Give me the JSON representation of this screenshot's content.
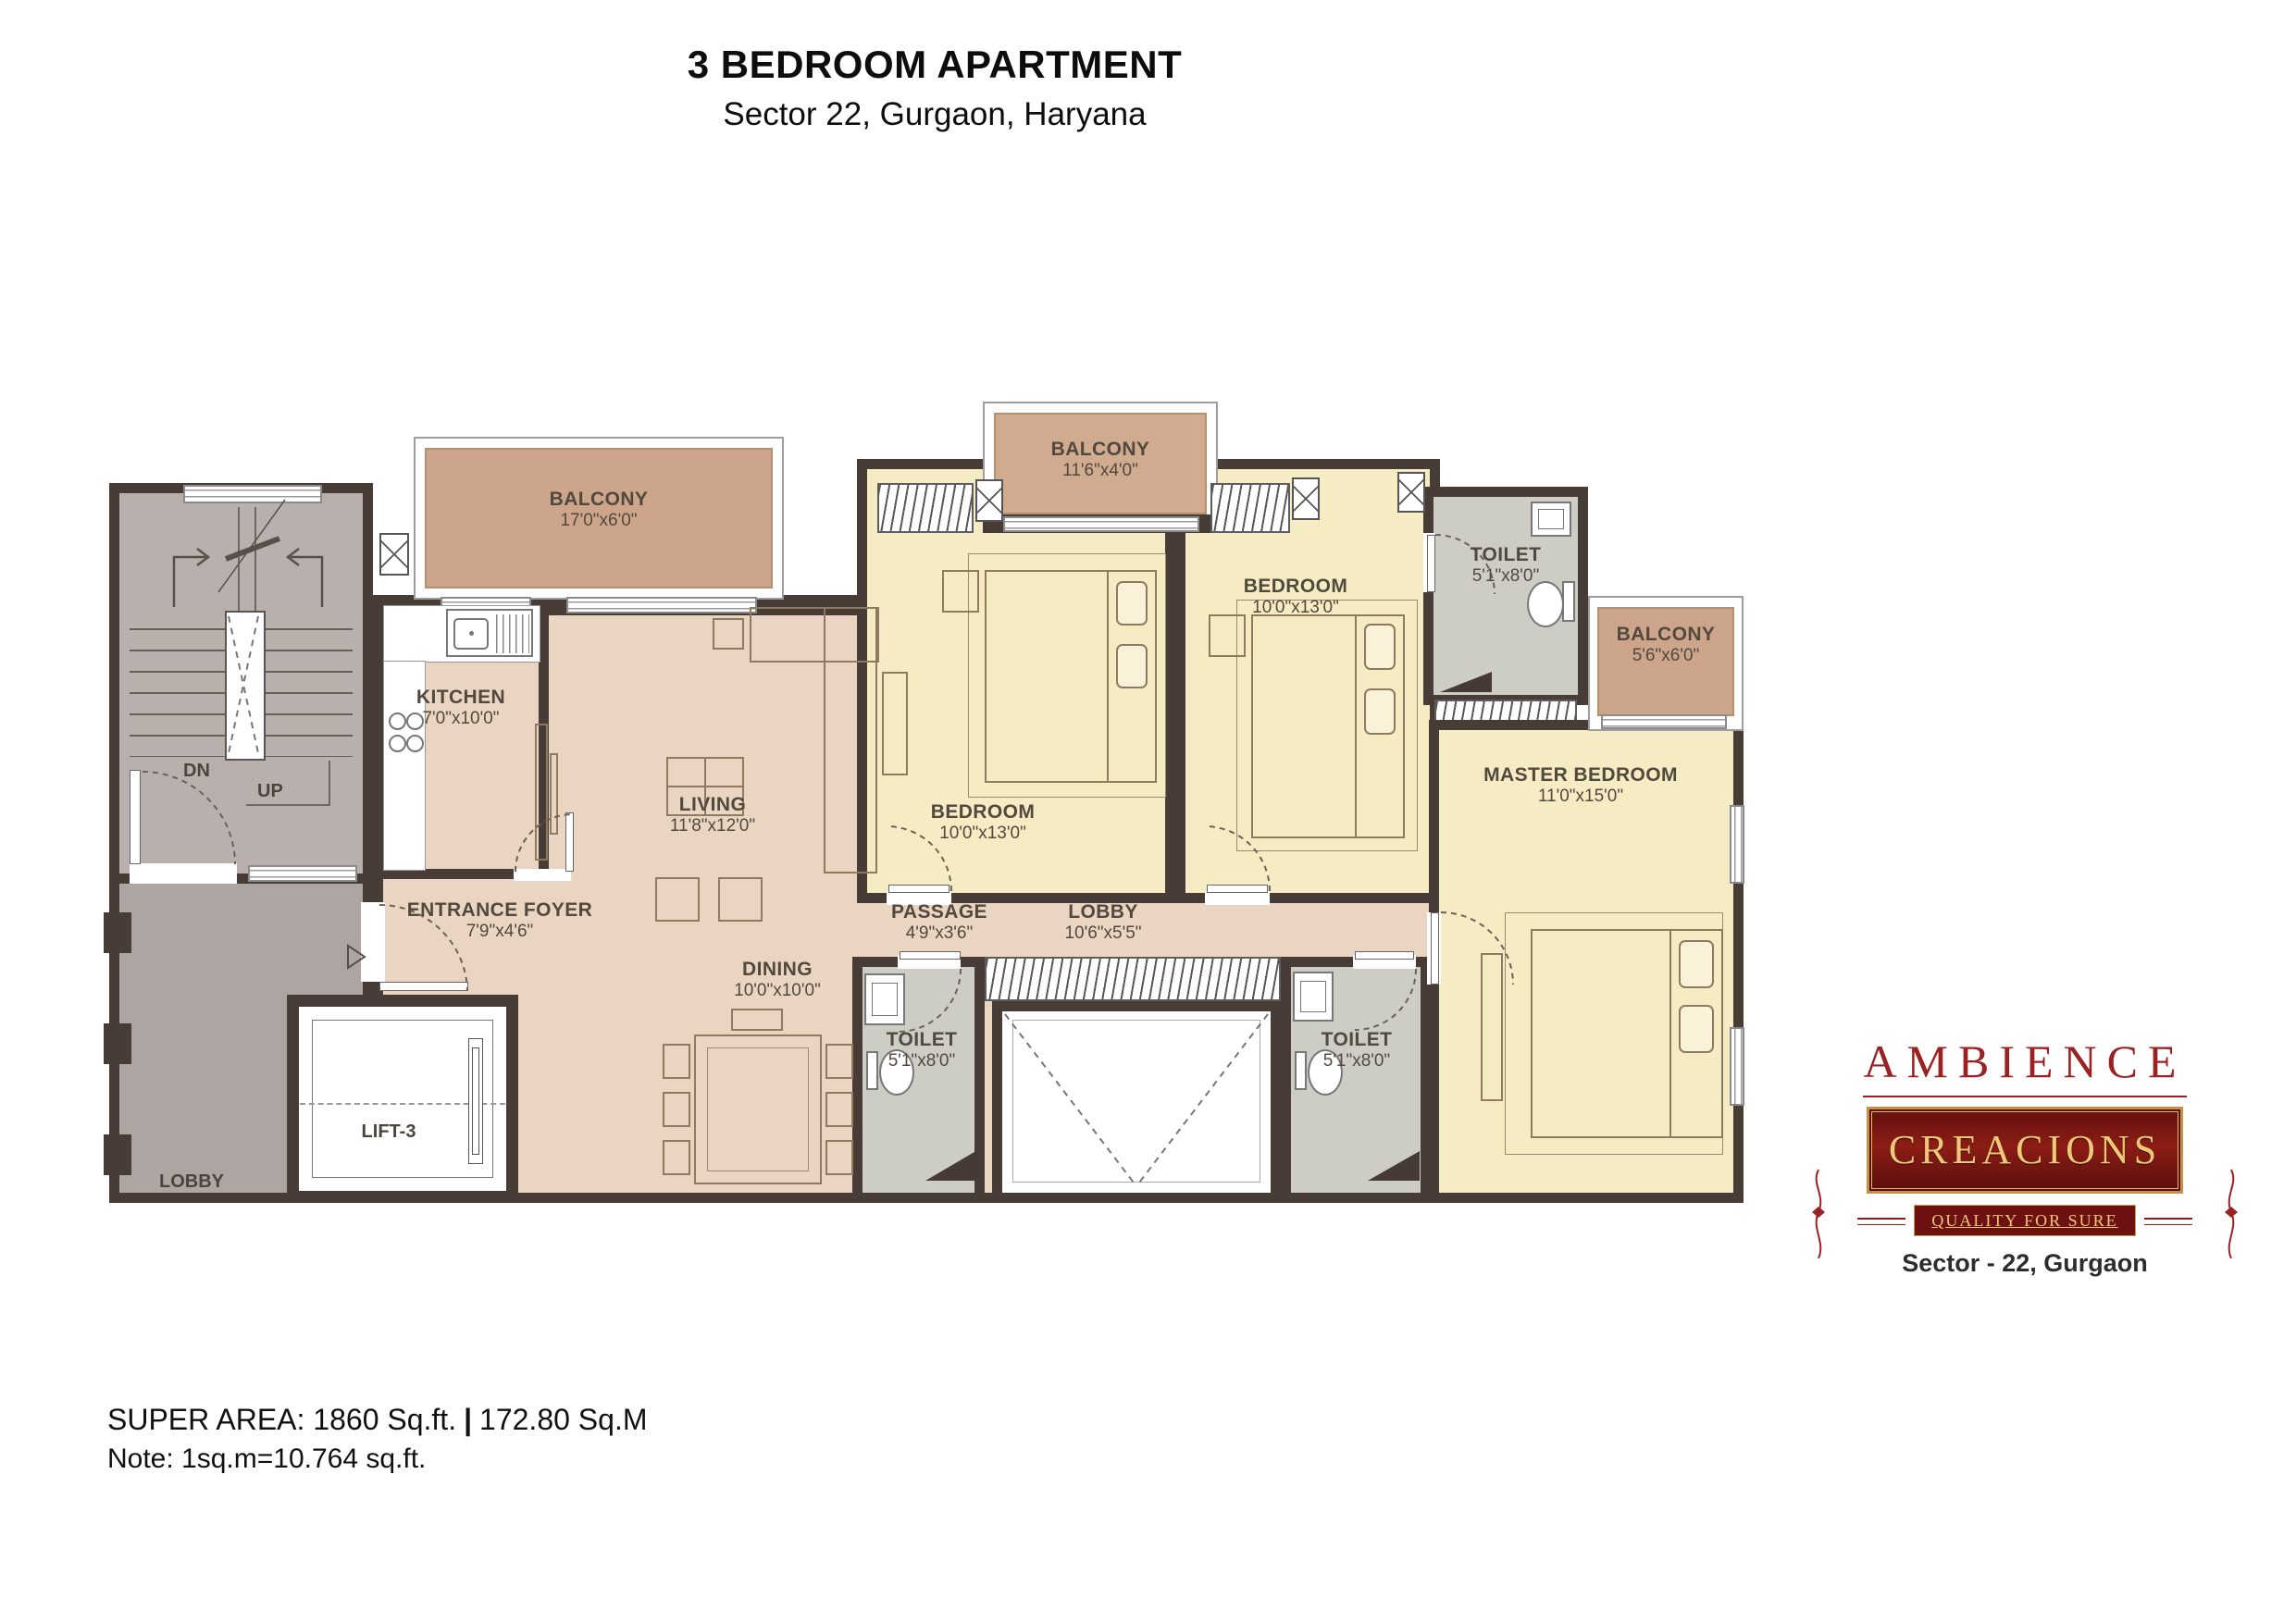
{
  "title": {
    "line1": "3 BEDROOM APARTMENT",
    "line2": "Sector 22, Gurgaon, Haryana"
  },
  "plan": {
    "rooms": {
      "balcony_tl": {
        "name": "BALCONY",
        "dims": "17'0\"x6'0\""
      },
      "balcony_mid": {
        "name": "BALCONY",
        "dims": "11'6\"x4'0\""
      },
      "balcony_r": {
        "name": "BALCONY",
        "dims": "5'6\"x6'0\""
      },
      "kitchen": {
        "name": "KITCHEN",
        "dims": "7'0\"x10'0\""
      },
      "living": {
        "name": "LIVING",
        "dims": "11'8\"x12'0\""
      },
      "dining": {
        "name": "DINING",
        "dims": "10'0\"x10'0\""
      },
      "foyer": {
        "name": "ENTRANCE FOYER",
        "dims": "7'9\"x4'6\""
      },
      "passage": {
        "name": "PASSAGE",
        "dims": "4'9\"x3'6\""
      },
      "lobby_inner": {
        "name": "LOBBY",
        "dims": "10'6\"x5'5\""
      },
      "bedroom1": {
        "name": "BEDROOM",
        "dims": "10'0\"x13'0\""
      },
      "bedroom2": {
        "name": "BEDROOM",
        "dims": "10'0\"x13'0\""
      },
      "master": {
        "name": "MASTER BEDROOM",
        "dims": "11'0\"x15'0\""
      },
      "toilet_tr": {
        "name": "TOILET",
        "dims": "5'1\"x8'0\""
      },
      "toilet_bl": {
        "name": "TOILET",
        "dims": "5'1\"x8'0\""
      },
      "toilet_br": {
        "name": "TOILET",
        "dims": "5'1\"x8'0\""
      }
    },
    "stair": {
      "dn": "DN",
      "up": "UP"
    },
    "lift": {
      "label": "LIFT-3"
    },
    "lobby_left": {
      "name": "LOBBY"
    }
  },
  "footer": {
    "area_ft": "SUPER AREA: 1860 Sq.ft.",
    "sep": "|",
    "area_m": "172.80 Sq.M",
    "note": "Note: 1sq.m=10.764 sq.ft."
  },
  "logo": {
    "brand": "AMBIENCE",
    "sub": "CREACIONS",
    "tagline": "QUALITY FOR SURE",
    "location": "Sector - 22, Gurgaon"
  },
  "colors": {
    "wall": "#483c36",
    "open_area": "#e9d5c1",
    "bedroom": "#f6ecc4",
    "balcony": "#cda58a",
    "toilet": "#cdcdc5",
    "stair_lobby": "#b9b0ad",
    "brand_red": "#9c2123",
    "gold": "#ecc878"
  }
}
